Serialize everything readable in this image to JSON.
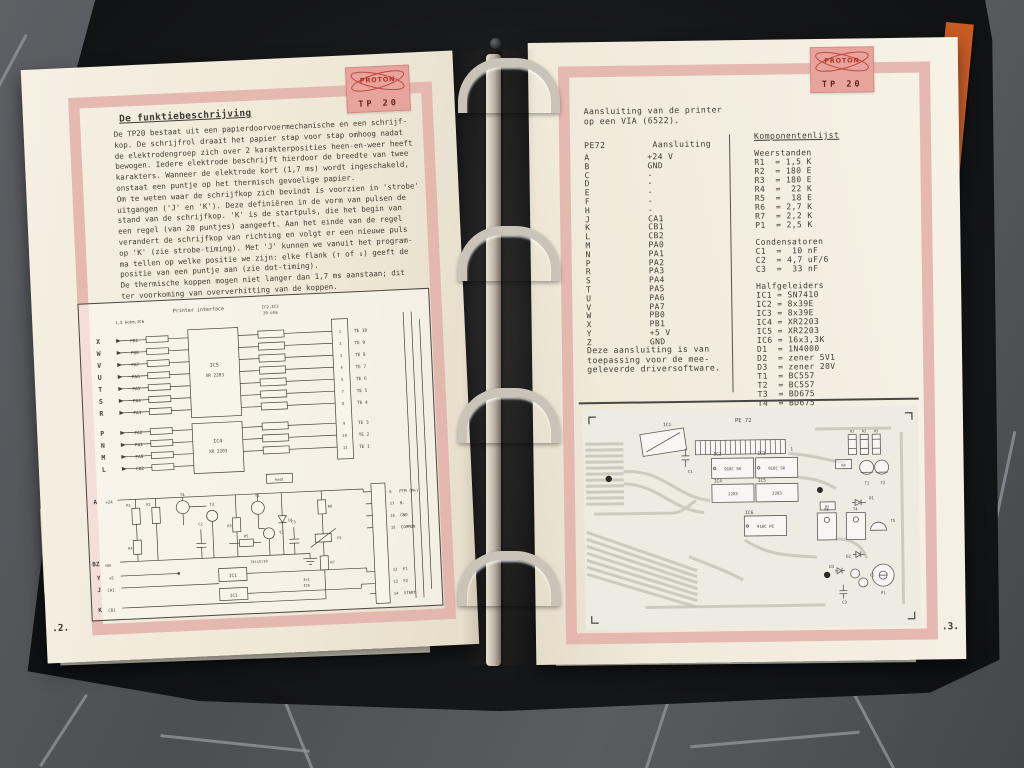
{
  "binder": {
    "tab": {
      "line_top": "88J/8/9",
      "line_bottom": "µPS-1"
    }
  },
  "left_page": {
    "stamp": {
      "brand": "PROTON",
      "model": "TP 20"
    },
    "title": "De funktiebeschrijving",
    "body": "De TP20 bestaat uit een papierdoorvoermechanische en een schrijf-\nkop. De schrijfrol draait het papier stap voor stap omhoog nadat\nde elektrodengroep zich over 2 karakterposities heen-en-weer heeft\nbewogen. Iedere elektrode beschrijft hierdoor de breedte van twee\nkarakters. Wanneer de elektrode kort (1,7 ms) wordt ingeschakeld,\nonstaat een puntje op het thermisch gevoelige papier.\nOm te weten waar de schrijfkop zich bevindt is voorzien in 'strobe'\nuitgangen ('J' en 'K'). Deze definiëren in de vorm van pulsen de\nstand van de schrijfkop. 'K' is de startpuls, die het begin van\neen regel (van 20 puntjes) aangeeft. Aan het einde van de regel\nverandert de schrijfkop van richting en volgt er een nieuwe puls\nop 'K' (zie strobe-timing). Met 'J' kunnen we vanuit het program-\nma tellen op welke positie we zijn: elke flank (↑ of ↓) geeft de\npositie van een puntje aan (zie dot-timing).\nDe thermische koppen mogen niet langer dan 1,7 ms aanstaan; dit\nter voorkoming van oververhitting van de koppen.",
    "page_number": ".2.",
    "schematic": {
      "labels": [
        {
          "t": "Printer interface",
          "x": 94,
          "y": 12,
          "fs": 5
        },
        {
          "t": "1,5 kohm,IC6",
          "x": 36,
          "y": 21,
          "fs": 4
        },
        {
          "t": "IC2,IC3",
          "x": 183,
          "y": 12,
          "fs": 4
        },
        {
          "t": "39 ohm",
          "x": 184,
          "y": 18,
          "fs": 4
        },
        {
          "t": "X",
          "x": 16,
          "y": 40,
          "fs": 6.5,
          "b": 1
        },
        {
          "t": "W",
          "x": 16,
          "y": 52,
          "fs": 6.5,
          "b": 1
        },
        {
          "t": "V",
          "x": 16,
          "y": 64,
          "fs": 6.5,
          "b": 1
        },
        {
          "t": "U",
          "x": 16,
          "y": 76,
          "fs": 6.5,
          "b": 1
        },
        {
          "t": "T",
          "x": 16,
          "y": 88,
          "fs": 6.5,
          "b": 1
        },
        {
          "t": "S",
          "x": 16,
          "y": 100,
          "fs": 6.5,
          "b": 1
        },
        {
          "t": "R",
          "x": 16,
          "y": 112,
          "fs": 6.5,
          "b": 1
        },
        {
          "t": "P",
          "x": 16,
          "y": 132,
          "fs": 6.5,
          "b": 1
        },
        {
          "t": "N",
          "x": 16,
          "y": 144,
          "fs": 6.5,
          "b": 1
        },
        {
          "t": "M",
          "x": 16,
          "y": 156,
          "fs": 6.5,
          "b": 1
        },
        {
          "t": "L",
          "x": 16,
          "y": 168,
          "fs": 6.5,
          "b": 1
        },
        {
          "t": "PB1",
          "x": 58,
          "y": 40,
          "a": "end"
        },
        {
          "t": "PB0",
          "x": 58,
          "y": 52,
          "a": "end"
        },
        {
          "t": "PA7",
          "x": 58,
          "y": 64,
          "a": "end"
        },
        {
          "t": "PA6",
          "x": 58,
          "y": 76,
          "a": "end"
        },
        {
          "t": "PA5",
          "x": 58,
          "y": 88,
          "a": "end"
        },
        {
          "t": "PA4",
          "x": 58,
          "y": 100,
          "a": "end"
        },
        {
          "t": "PA3",
          "x": 58,
          "y": 112,
          "a": "end"
        },
        {
          "t": "PA2",
          "x": 58,
          "y": 132,
          "a": "end"
        },
        {
          "t": "PA1",
          "x": 58,
          "y": 144,
          "a": "end"
        },
        {
          "t": "PA0",
          "x": 58,
          "y": 156,
          "a": "end"
        },
        {
          "t": "CB2",
          "x": 58,
          "y": 168,
          "a": "end"
        },
        {
          "t": "IC5",
          "x": 133,
          "y": 68,
          "a": "middle",
          "fs": 5
        },
        {
          "t": "XR 2203",
          "x": 133,
          "y": 78,
          "a": "middle",
          "fs": 4.4
        },
        {
          "t": "IC4",
          "x": 133,
          "y": 144,
          "a": "middle",
          "fs": 5
        },
        {
          "t": "XR 2203",
          "x": 133,
          "y": 154,
          "a": "middle",
          "fs": 4.4
        },
        {
          "t": "1",
          "x": 260,
          "y": 40,
          "a": "middle",
          "fs": 3.8
        },
        {
          "t": "2",
          "x": 260,
          "y": 52,
          "a": "middle",
          "fs": 3.8
        },
        {
          "t": "3",
          "x": 260,
          "y": 64,
          "a": "middle",
          "fs": 3.8
        },
        {
          "t": "4",
          "x": 260,
          "y": 76,
          "a": "middle",
          "fs": 3.8
        },
        {
          "t": "5",
          "x": 260,
          "y": 88,
          "a": "middle",
          "fs": 3.8
        },
        {
          "t": "7",
          "x": 260,
          "y": 100,
          "a": "middle",
          "fs": 3.8
        },
        {
          "t": "8",
          "x": 260,
          "y": 112,
          "a": "middle",
          "fs": 3.8
        },
        {
          "t": "9",
          "x": 260,
          "y": 132,
          "a": "middle",
          "fs": 3.8
        },
        {
          "t": "10",
          "x": 260,
          "y": 144,
          "a": "middle",
          "fs": 3.8
        },
        {
          "t": "11",
          "x": 260,
          "y": 156,
          "a": "middle",
          "fs": 3.8
        },
        {
          "t": "TE 10",
          "x": 274,
          "y": 40
        },
        {
          "t": "TE 9",
          "x": 274,
          "y": 52
        },
        {
          "t": "TE 8",
          "x": 274,
          "y": 64
        },
        {
          "t": "TE 7",
          "x": 274,
          "y": 76
        },
        {
          "t": "TE 6",
          "x": 274,
          "y": 88
        },
        {
          "t": "TE 5",
          "x": 274,
          "y": 100
        },
        {
          "t": "TE 4",
          "x": 274,
          "y": 112
        },
        {
          "t": "TE 3",
          "x": 274,
          "y": 132
        },
        {
          "t": "TE 2",
          "x": 274,
          "y": 144
        },
        {
          "t": "TE 1",
          "x": 274,
          "y": 156
        },
        {
          "t": "heat",
          "x": 193,
          "y": 185,
          "a": "middle",
          "fs": 3.8
        },
        {
          "t": "A",
          "x": 6,
          "y": 200,
          "fs": 6,
          "b": 1
        },
        {
          "t": "+24",
          "x": 18,
          "y": 200,
          "fs": 4
        },
        {
          "t": "BZ",
          "x": 2,
          "y": 262,
          "fs": 6,
          "b": 1
        },
        {
          "t": "GND",
          "x": 15,
          "y": 263,
          "fs": 3.2
        },
        {
          "t": "Y",
          "x": 6,
          "y": 276,
          "fs": 6,
          "b": 1
        },
        {
          "t": "+5",
          "x": 18,
          "y": 276,
          "fs": 4
        },
        {
          "t": "J",
          "x": 6,
          "y": 288,
          "fs": 6,
          "b": 1
        },
        {
          "t": "CA1",
          "x": 16,
          "y": 288,
          "fs": 4
        },
        {
          "t": "K",
          "x": 6,
          "y": 308,
          "fs": 6,
          "b": 1
        },
        {
          "t": "CB1",
          "x": 16,
          "y": 308,
          "fs": 4
        },
        {
          "t": "T4",
          "x": 95,
          "y": 196,
          "a": "middle",
          "fs": 4
        },
        {
          "t": "T3",
          "x": 124,
          "y": 207,
          "a": "middle",
          "fs": 4
        },
        {
          "t": "T1",
          "x": 170,
          "y": 200,
          "a": "middle",
          "fs": 4
        },
        {
          "t": "T2",
          "x": 190,
          "y": 238,
          "fs": 4
        },
        {
          "t": "R1",
          "x": 43,
          "y": 204,
          "a": "end",
          "fs": 3.6
        },
        {
          "t": "R2",
          "x": 63,
          "y": 204,
          "a": "end",
          "fs": 3.6
        },
        {
          "t": "R4",
          "x": 43,
          "y": 247,
          "a": "end",
          "fs": 3.6
        },
        {
          "t": "R3",
          "x": 143,
          "y": 229,
          "a": "end",
          "fs": 3.6
        },
        {
          "t": "D1",
          "x": 200,
          "y": 226,
          "fs": 3.6
        },
        {
          "t": "R5",
          "x": 157,
          "y": 240,
          "a": "middle",
          "fs": 3.6
        },
        {
          "t": "R6",
          "x": 240,
          "y": 214,
          "fs": 3.6
        },
        {
          "t": "P1",
          "x": 248,
          "y": 246,
          "fs": 3.6
        },
        {
          "t": "R7",
          "x": 240,
          "y": 270,
          "fs": 3.6
        },
        {
          "t": "C2",
          "x": 112,
          "y": 226,
          "a": "middle",
          "fs": 3.6
        },
        {
          "t": "C3",
          "x": 205,
          "y": 228,
          "a": "middle",
          "fs": 3.6
        },
        {
          "t": "IC1",
          "x": 142,
          "y": 279,
          "a": "middle",
          "fs": 4.4
        },
        {
          "t": "IC1",
          "x": 142,
          "y": 299,
          "a": "middle",
          "fs": 4.4
        },
        {
          "t": "74(LS)10",
          "x": 160,
          "y": 266,
          "fs": 3.6
        },
        {
          "t": "3x1",
          "x": 212,
          "y": 286,
          "fs": 3.6
        },
        {
          "t": "IC6",
          "x": 212,
          "y": 292,
          "fs": 3.6
        },
        {
          "t": "6",
          "x": 302,
          "y": 202,
          "fs": 3.8
        },
        {
          "t": "PTM (M+)",
          "x": 312,
          "y": 202,
          "fs": 4
        },
        {
          "t": "17",
          "x": 302,
          "y": 214,
          "fs": 3.8
        },
        {
          "t": "M-",
          "x": 312,
          "y": 214,
          "fs": 4
        },
        {
          "t": "16",
          "x": 302,
          "y": 226,
          "fs": 3.8
        },
        {
          "t": "GND",
          "x": 312,
          "y": 226,
          "fs": 4
        },
        {
          "t": "15",
          "x": 302,
          "y": 238,
          "fs": 3.8
        },
        {
          "t": "COMMON",
          "x": 312,
          "y": 238,
          "fs": 4
        },
        {
          "t": "12",
          "x": 302,
          "y": 280,
          "fs": 3.8
        },
        {
          "t": "F1",
          "x": 312,
          "y": 280,
          "fs": 4
        },
        {
          "t": "13",
          "x": 302,
          "y": 292,
          "fs": 3.8
        },
        {
          "t": "F2",
          "x": 312,
          "y": 292,
          "fs": 4
        },
        {
          "t": "14",
          "x": 302,
          "y": 304,
          "fs": 3.8
        },
        {
          "t": "START",
          "x": 312,
          "y": 304,
          "fs": 4
        }
      ]
    }
  },
  "right_page": {
    "stamp": {
      "brand": "PROTON",
      "model": "TP 20"
    },
    "heading": "Aansluiting van de printer\nop een VIA (6522).",
    "pin_table": {
      "col1": "PE72",
      "col2": "Aansluiting",
      "rows": [
        {
          "p": "A",
          "s": "+24 V"
        },
        {
          "p": "B",
          "s": "GND"
        },
        {
          "p": "C",
          "s": "-"
        },
        {
          "p": "D",
          "s": "-"
        },
        {
          "p": "E",
          "s": "-"
        },
        {
          "p": "F",
          "s": "-"
        },
        {
          "p": "H",
          "s": "-"
        },
        {
          "p": "J",
          "s": "CA1"
        },
        {
          "p": "K",
          "s": "CB1"
        },
        {
          "p": "L",
          "s": "CB2"
        },
        {
          "p": "M",
          "s": "PA0"
        },
        {
          "p": "N",
          "s": "PA1"
        },
        {
          "p": "P",
          "s": "PA2"
        },
        {
          "p": "R",
          "s": "PA3"
        },
        {
          "p": "S",
          "s": "PA4"
        },
        {
          "p": "T",
          "s": "PA5"
        },
        {
          "p": "U",
          "s": "PA6"
        },
        {
          "p": "V",
          "s": "PA7"
        },
        {
          "p": "W",
          "s": "PB0"
        },
        {
          "p": "X",
          "s": "PB1"
        },
        {
          "p": "Y",
          "s": "+5 V"
        },
        {
          "p": "Z",
          "s": "GND"
        }
      ]
    },
    "note": "Deze aansluiting is van\ntoepassing voor de mee-\ngeleverde driversoftware.",
    "components": {
      "title": "Komponentenlijst",
      "sections": [
        {
          "name": "Weerstanden",
          "items": [
            "R1  = 1,5 K",
            "R2  = 180 E",
            "R3  = 180 E",
            "R4  =  22 K",
            "R5  =  18 E",
            "R6  = 2,7 K",
            "R7  = 2,2 K",
            "P1  = 2,5 K"
          ]
        },
        {
          "name": "Condensatoren",
          "items": [
            "C1  =  10 nF",
            "C2  = 4,7 uF/6",
            "C3  =  33 nF"
          ]
        },
        {
          "name": "Halfgeleiders",
          "items": [
            "IC1 = SN7410",
            "IC2 = 8x39E",
            "IC3 = 8x39E",
            "IC4 = XR2203",
            "IC5 = XR2203",
            "IC6 = 16x3,3K",
            "D1  = 1N4000",
            "D2  = zener 5V1",
            "D3  = zener 20V",
            "T1  = BC557",
            "T2  = BC557",
            "T3  = BD675",
            "T4  = BD675",
            "T5  = BC547"
          ]
        }
      ]
    },
    "pcb": {
      "labels": [
        {
          "t": "PE 72",
          "x": 152,
          "y": 14,
          "fs": 5.5
        },
        {
          "t": "1",
          "x": 207,
          "y": 43,
          "fs": 4.5
        },
        {
          "t": "IC1",
          "x": 80,
          "y": 17,
          "fs": 4.5
        },
        {
          "t": "C1",
          "x": 104,
          "y": 64,
          "fs": 4
        },
        {
          "t": "IC2",
          "x": 130,
          "y": 47,
          "fs": 4.5
        },
        {
          "t": "IC3",
          "x": 174,
          "y": 47,
          "fs": 4.5
        },
        {
          "t": "916C SR",
          "x": 149,
          "y": 62,
          "a": "middle",
          "fs": 4
        },
        {
          "t": "916C SR",
          "x": 193,
          "y": 62,
          "a": "middle",
          "fs": 4
        },
        {
          "t": "IC4",
          "x": 130,
          "y": 74,
          "fs": 4.5
        },
        {
          "t": "IC5",
          "x": 174,
          "y": 74,
          "fs": 4.5
        },
        {
          "t": "2203",
          "x": 149,
          "y": 87,
          "a": "middle",
          "fs": 4
        },
        {
          "t": "2203",
          "x": 193,
          "y": 87,
          "a": "middle",
          "fs": 4
        },
        {
          "t": "IC6",
          "x": 161,
          "y": 106,
          "fs": 4.5
        },
        {
          "t": "916C PE",
          "x": 181,
          "y": 120,
          "a": "middle",
          "fs": 4
        },
        {
          "t": "R1",
          "x": 269,
          "y": 26,
          "a": "middle",
          "fs": 3.4
        },
        {
          "t": "R2",
          "x": 281,
          "y": 26,
          "a": "middle",
          "fs": 3.4
        },
        {
          "t": "R3",
          "x": 293,
          "y": 26,
          "a": "middle",
          "fs": 3.4
        },
        {
          "t": "R4",
          "x": 260,
          "y": 60,
          "a": "middle",
          "fs": 3.6
        },
        {
          "t": "T1",
          "x": 283,
          "y": 78,
          "a": "middle",
          "fs": 4
        },
        {
          "t": "T2",
          "x": 299,
          "y": 78,
          "a": "middle",
          "fs": 4
        },
        {
          "t": "R5",
          "x": 243,
          "y": 101,
          "a": "middle",
          "fs": 3.4
        },
        {
          "t": "D1",
          "x": 285,
          "y": 93,
          "fs": 4
        },
        {
          "t": "T3",
          "x": 242,
          "y": 104,
          "a": "middle",
          "fs": 4
        },
        {
          "t": "T4",
          "x": 271,
          "y": 104,
          "a": "middle",
          "fs": 4
        },
        {
          "t": "T5",
          "x": 306,
          "y": 116,
          "fs": 4
        },
        {
          "t": "D2",
          "x": 266,
          "y": 151,
          "a": "end",
          "fs": 4
        },
        {
          "t": "D3",
          "x": 249,
          "y": 161,
          "a": "end",
          "fs": 4
        },
        {
          "t": "C2",
          "x": 285,
          "y": 170,
          "fs": 3.6
        },
        {
          "t": "C3",
          "x": 259,
          "y": 197,
          "a": "middle",
          "fs": 4
        },
        {
          "t": "P1",
          "x": 298,
          "y": 188,
          "a": "middle",
          "fs": 4
        }
      ]
    },
    "page_number": ".3."
  }
}
